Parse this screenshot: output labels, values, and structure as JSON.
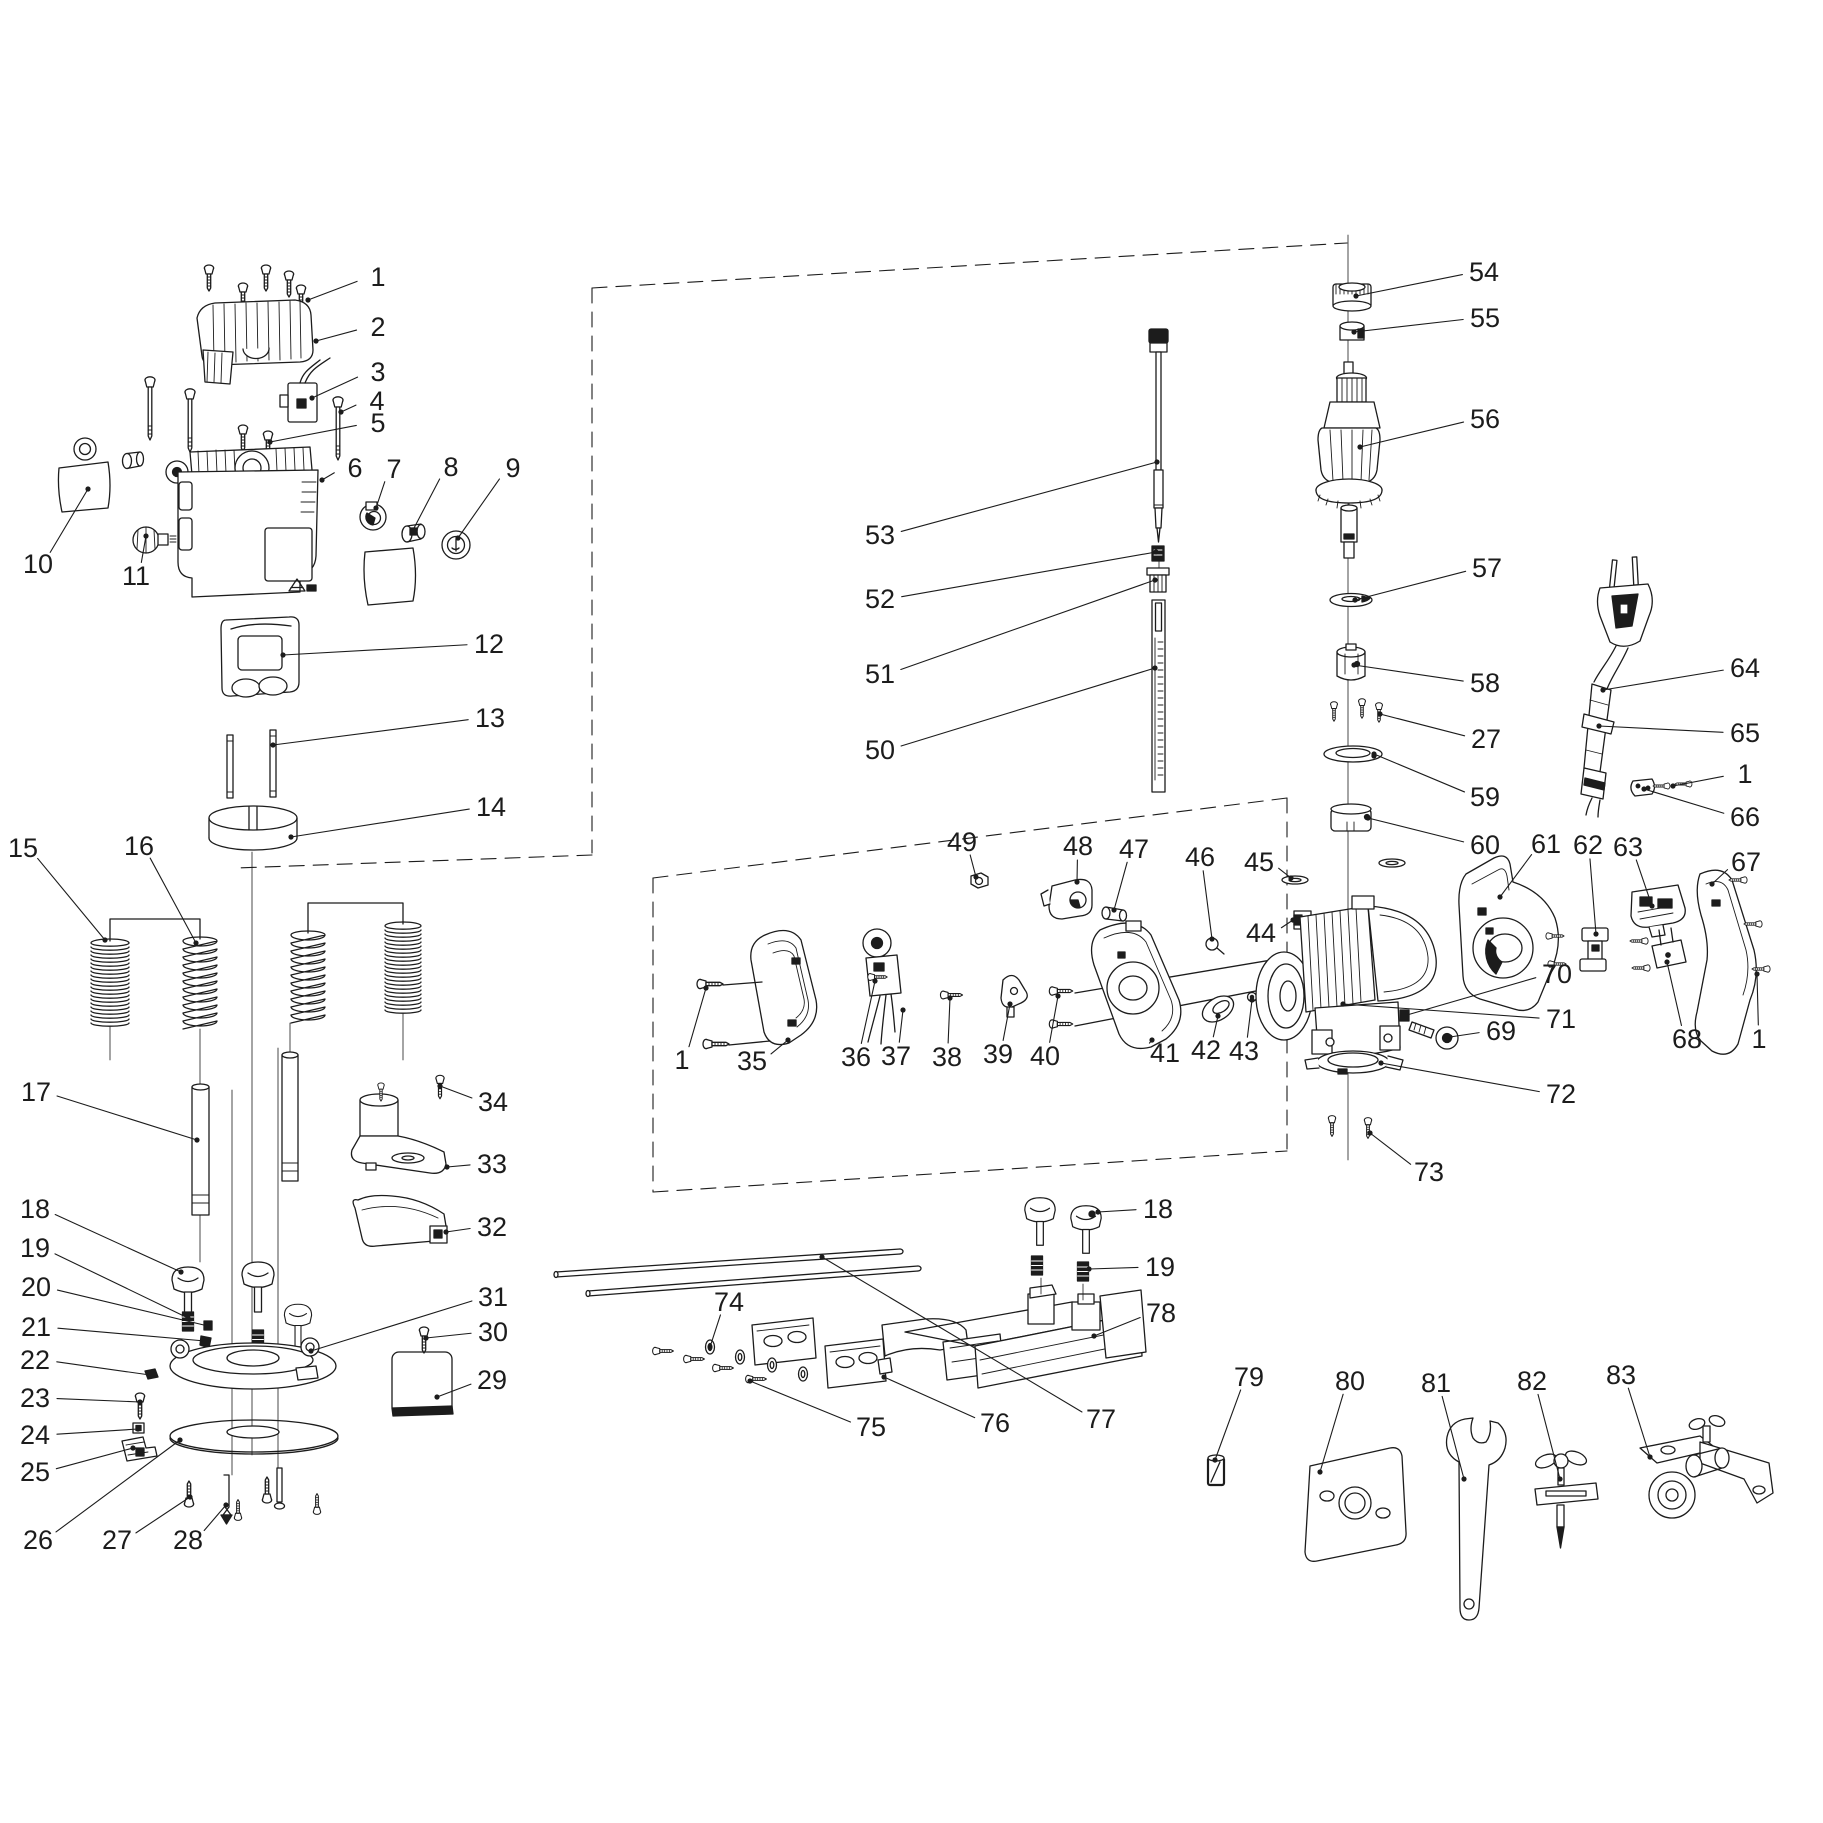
{
  "diagram": {
    "kind": "exploded-parts-diagram",
    "subject": "plunge router power tool - exploded view with numbered parts",
    "background_color": "#ffffff",
    "line_color": "#1c1c1c",
    "part_count_max": 83,
    "labels": [
      {
        "t": "1",
        "x": 378,
        "y": 277,
        "tx": 308,
        "ty": 300
      },
      {
        "t": "2",
        "x": 378,
        "y": 327,
        "tx": 316,
        "ty": 341
      },
      {
        "t": "3",
        "x": 378,
        "y": 372,
        "tx": 312,
        "ty": 398
      },
      {
        "t": "4",
        "x": 377,
        "y": 401,
        "tx": 341,
        "ty": 412
      },
      {
        "t": "5",
        "x": 378,
        "y": 423,
        "tx": 270,
        "ty": 442
      },
      {
        "t": "6",
        "x": 355,
        "y": 468,
        "tx": 322,
        "ty": 480
      },
      {
        "t": "7",
        "x": 394,
        "y": 469,
        "tx": 376,
        "ty": 508
      },
      {
        "t": "8",
        "x": 451,
        "y": 467,
        "tx": 413,
        "ty": 530
      },
      {
        "t": "9",
        "x": 513,
        "y": 468,
        "tx": 458,
        "ty": 538
      },
      {
        "t": "10",
        "x": 38,
        "y": 564,
        "tx": 88,
        "ty": 489
      },
      {
        "t": "11",
        "x": 136,
        "y": 576,
        "tx": 146,
        "ty": 536
      },
      {
        "t": "12",
        "x": 489,
        "y": 644,
        "tx": 283,
        "ty": 655
      },
      {
        "t": "13",
        "x": 490,
        "y": 718,
        "tx": 273,
        "ty": 745
      },
      {
        "t": "14",
        "x": 491,
        "y": 807,
        "tx": 291,
        "ty": 837
      },
      {
        "t": "15",
        "x": 23,
        "y": 848,
        "tx": 105,
        "ty": 940
      },
      {
        "t": "16",
        "x": 139,
        "y": 846,
        "tx": 196,
        "ty": 943
      },
      {
        "t": "17",
        "x": 36,
        "y": 1092,
        "tx": 197,
        "ty": 1140
      },
      {
        "t": "18",
        "x": 35,
        "y": 1209,
        "tx": 181,
        "ty": 1272
      },
      {
        "t": "19",
        "x": 35,
        "y": 1248,
        "tx": 188,
        "ty": 1318
      },
      {
        "t": "20",
        "x": 36,
        "y": 1287,
        "tx": 208,
        "ty": 1326
      },
      {
        "t": "21",
        "x": 36,
        "y": 1327,
        "tx": 205,
        "ty": 1341
      },
      {
        "t": "22",
        "x": 35,
        "y": 1360,
        "tx": 150,
        "ty": 1375
      },
      {
        "t": "23",
        "x": 35,
        "y": 1398,
        "tx": 140,
        "ty": 1402
      },
      {
        "t": "24",
        "x": 35,
        "y": 1435,
        "tx": 138,
        "ty": 1429
      },
      {
        "t": "25",
        "x": 35,
        "y": 1472,
        "tx": 133,
        "ty": 1448
      },
      {
        "t": "26",
        "x": 38,
        "y": 1540,
        "tx": 180,
        "ty": 1440
      },
      {
        "t": "27",
        "x": 117,
        "y": 1540,
        "tx": 190,
        "ty": 1497
      },
      {
        "t": "28",
        "x": 188,
        "y": 1540,
        "tx": 226,
        "ty": 1505
      },
      {
        "t": "29",
        "x": 492,
        "y": 1380,
        "tx": 437,
        "ty": 1397
      },
      {
        "t": "30",
        "x": 493,
        "y": 1332,
        "tx": 426,
        "ty": 1338
      },
      {
        "t": "31",
        "x": 493,
        "y": 1297,
        "tx": 311,
        "ty": 1351
      },
      {
        "t": "32",
        "x": 492,
        "y": 1227,
        "tx": 446,
        "ty": 1232
      },
      {
        "t": "33",
        "x": 492,
        "y": 1164,
        "tx": 447,
        "ty": 1167
      },
      {
        "t": "34",
        "x": 493,
        "y": 1102,
        "tx": 440,
        "ty": 1086
      },
      {
        "t": "1",
        "x": 682,
        "y": 1060,
        "tx": 706,
        "ty": 988
      },
      {
        "t": "35",
        "x": 752,
        "y": 1061,
        "tx": 788,
        "ty": 1040
      },
      {
        "t": "36",
        "x": 856,
        "y": 1057,
        "tx": 875,
        "ty": 981
      },
      {
        "t": "37",
        "x": 896,
        "y": 1056,
        "tx": 903,
        "ty": 1010
      },
      {
        "t": "38",
        "x": 947,
        "y": 1057,
        "tx": 950,
        "ty": 998
      },
      {
        "t": "39",
        "x": 998,
        "y": 1054,
        "tx": 1010,
        "ty": 1004
      },
      {
        "t": "40",
        "x": 1045,
        "y": 1056,
        "tx": 1058,
        "ty": 996
      },
      {
        "t": "41",
        "x": 1165,
        "y": 1053,
        "tx": 1152,
        "ty": 1040
      },
      {
        "t": "42",
        "x": 1206,
        "y": 1050,
        "tx": 1218,
        "ty": 1016
      },
      {
        "t": "43",
        "x": 1244,
        "y": 1051,
        "tx": 1252,
        "ty": 1000
      },
      {
        "t": "44",
        "x": 1261,
        "y": 933,
        "tx": 1293,
        "ty": 920
      },
      {
        "t": "45",
        "x": 1259,
        "y": 862,
        "tx": 1291,
        "ty": 878
      },
      {
        "t": "46",
        "x": 1200,
        "y": 857,
        "tx": 1212,
        "ty": 939
      },
      {
        "t": "47",
        "x": 1134,
        "y": 849,
        "tx": 1114,
        "ty": 910
      },
      {
        "t": "48",
        "x": 1078,
        "y": 846,
        "tx": 1077,
        "ty": 882
      },
      {
        "t": "49",
        "x": 962,
        "y": 842,
        "tx": 976,
        "ty": 877
      },
      {
        "t": "50",
        "x": 880,
        "y": 750,
        "tx": 1155,
        "ty": 668
      },
      {
        "t": "51",
        "x": 880,
        "y": 674,
        "tx": 1155,
        "ty": 580
      },
      {
        "t": "52",
        "x": 880,
        "y": 599,
        "tx": 1156,
        "ty": 552
      },
      {
        "t": "53",
        "x": 880,
        "y": 535,
        "tx": 1157,
        "ty": 462
      },
      {
        "t": "54",
        "x": 1484,
        "y": 272,
        "tx": 1356,
        "ty": 296
      },
      {
        "t": "55",
        "x": 1485,
        "y": 318,
        "tx": 1354,
        "ty": 332
      },
      {
        "t": "56",
        "x": 1485,
        "y": 419,
        "tx": 1360,
        "ty": 447
      },
      {
        "t": "57",
        "x": 1487,
        "y": 568,
        "tx": 1355,
        "ty": 600
      },
      {
        "t": "58",
        "x": 1485,
        "y": 683,
        "tx": 1354,
        "ty": 665
      },
      {
        "t": "27",
        "x": 1486,
        "y": 739,
        "tx": 1380,
        "ty": 714
      },
      {
        "t": "59",
        "x": 1485,
        "y": 797,
        "tx": 1374,
        "ty": 754
      },
      {
        "t": "60",
        "x": 1485,
        "y": 845,
        "tx": 1368,
        "ty": 818
      },
      {
        "t": "61",
        "x": 1546,
        "y": 844,
        "tx": 1500,
        "ty": 897
      },
      {
        "t": "62",
        "x": 1588,
        "y": 845,
        "tx": 1596,
        "ty": 934
      },
      {
        "t": "63",
        "x": 1628,
        "y": 847,
        "tx": 1652,
        "ty": 906
      },
      {
        "t": "64",
        "x": 1745,
        "y": 668,
        "tx": 1603,
        "ty": 690
      },
      {
        "t": "65",
        "x": 1745,
        "y": 733,
        "tx": 1599,
        "ty": 726
      },
      {
        "t": "1",
        "x": 1745,
        "y": 774,
        "tx": 1673,
        "ty": 786
      },
      {
        "t": "66",
        "x": 1745,
        "y": 817,
        "tx": 1644,
        "ty": 789
      },
      {
        "t": "67",
        "x": 1746,
        "y": 862,
        "tx": 1712,
        "ty": 884
      },
      {
        "t": "68",
        "x": 1687,
        "y": 1039,
        "tx": 1667,
        "ty": 962
      },
      {
        "t": "1",
        "x": 1759,
        "y": 1039,
        "tx": 1757,
        "ty": 974
      },
      {
        "t": "69",
        "x": 1501,
        "y": 1031,
        "tx": 1450,
        "ty": 1037
      },
      {
        "t": "70",
        "x": 1557,
        "y": 974,
        "tx": 1407,
        "ty": 1015
      },
      {
        "t": "71",
        "x": 1561,
        "y": 1019,
        "tx": 1343,
        "ty": 1004
      },
      {
        "t": "72",
        "x": 1561,
        "y": 1094,
        "tx": 1381,
        "ty": 1063
      },
      {
        "t": "73",
        "x": 1429,
        "y": 1172,
        "tx": 1370,
        "ty": 1133
      },
      {
        "t": "74",
        "x": 729,
        "y": 1302,
        "tx": 710,
        "ty": 1347
      },
      {
        "t": "75",
        "x": 871,
        "y": 1427,
        "tx": 750,
        "ty": 1381
      },
      {
        "t": "76",
        "x": 995,
        "y": 1423,
        "tx": 884,
        "ty": 1377
      },
      {
        "t": "77",
        "x": 1101,
        "y": 1419,
        "tx": 822,
        "ty": 1257
      },
      {
        "t": "78",
        "x": 1161,
        "y": 1313,
        "tx": 1094,
        "ty": 1336
      },
      {
        "t": "18",
        "x": 1158,
        "y": 1209,
        "tx": 1098,
        "ty": 1212
      },
      {
        "t": "19",
        "x": 1160,
        "y": 1267,
        "tx": 1089,
        "ty": 1269
      },
      {
        "t": "79",
        "x": 1249,
        "y": 1377,
        "tx": 1215,
        "ty": 1460
      },
      {
        "t": "80",
        "x": 1350,
        "y": 1381,
        "tx": 1320,
        "ty": 1472
      },
      {
        "t": "81",
        "x": 1436,
        "y": 1383,
        "tx": 1464,
        "ty": 1479
      },
      {
        "t": "82",
        "x": 1532,
        "y": 1381,
        "tx": 1560,
        "ty": 1479
      },
      {
        "t": "83",
        "x": 1621,
        "y": 1375,
        "tx": 1650,
        "ty": 1457
      }
    ],
    "springs": [
      {
        "cx": 110,
        "top": 943,
        "w": 38,
        "coils": 21,
        "pitch": 4,
        "style": "dense"
      },
      {
        "cx": 200,
        "top": 941,
        "w": 34,
        "coils": 11,
        "pitch": 8,
        "style": "loose"
      },
      {
        "cx": 308,
        "top": 935,
        "w": 34,
        "coils": 11,
        "pitch": 8,
        "style": "loose"
      },
      {
        "cx": 403,
        "top": 926,
        "w": 36,
        "coils": 22,
        "pitch": 4,
        "style": "dense"
      }
    ]
  }
}
